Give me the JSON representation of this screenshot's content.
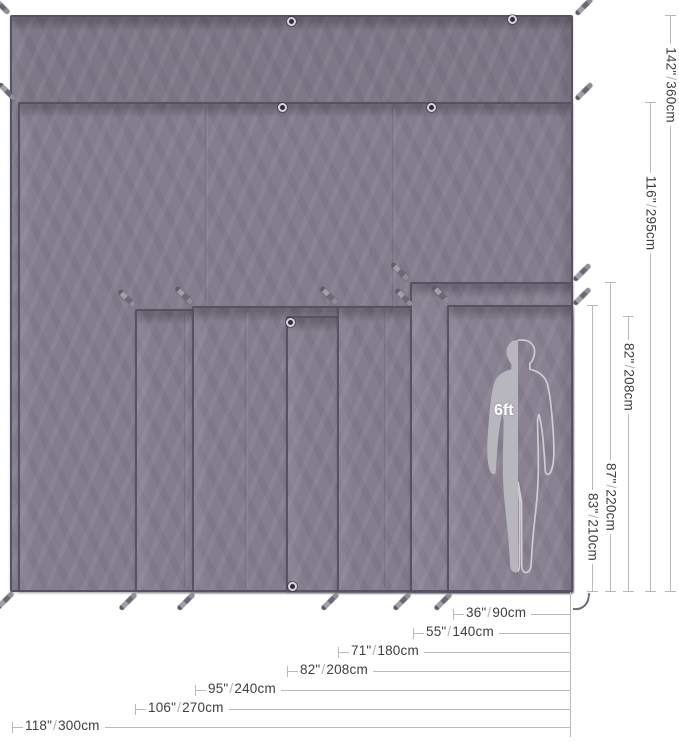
{
  "person": {
    "label": "6ft"
  },
  "colors": {
    "fabric_dark": "#7d7787",
    "fabric_mid": "#837d8e",
    "fabric_light": "#878192",
    "tarp_edge": "#575262",
    "dim_line": "#b9b9b9",
    "dim_text": "#3e3e3e",
    "dim_slash": "#b0b0b0",
    "silhouette_fill": "#b8b6bd",
    "silhouette_outline": "#cfcdd4",
    "background": "#ffffff"
  },
  "baseline": {
    "bottom_y": 592,
    "right_x": 573,
    "connector_x": 570,
    "connector_top": 592,
    "connector_bottom": 737
  },
  "tarps": [
    {
      "width_label": "118\"/300cm",
      "height_label": "142\"/360cm",
      "x": 10,
      "y": 15,
      "w": 563,
      "h": 577,
      "shade": "dark",
      "seams": []
    },
    {
      "width_label": "",
      "height_label": "116\"/295cm",
      "x": 18,
      "y": 102,
      "w": 555,
      "h": 490,
      "shade": "mid",
      "seams": [
        185,
        372
      ]
    },
    {
      "width_label": "106\"/270cm",
      "height_label": "",
      "x": 135,
      "y": 309,
      "w": 438,
      "h": 283,
      "shade": "mid",
      "seams": [
        47
      ]
    },
    {
      "width_label": "95\"/240cm",
      "height_label": "",
      "x": 192,
      "y": 306,
      "w": 381,
      "h": 286,
      "shade": "mid",
      "seams": [
        51
      ]
    },
    {
      "width_label": "82\"/208cm",
      "height_label": "82\"/208cm",
      "x": 286,
      "y": 316,
      "w": 287,
      "h": 276,
      "shade": "mid",
      "seams": []
    },
    {
      "width_label": "71\"/180cm",
      "height_label": "",
      "x": 337,
      "y": 306,
      "w": 236,
      "h": 286,
      "shade": "mid",
      "seams": [
        45
      ]
    },
    {
      "width_label": "55\"/140cm",
      "height_label": "87\"/220cm",
      "x": 410,
      "y": 282,
      "w": 163,
      "h": 310,
      "shade": "light",
      "seams": []
    },
    {
      "width_label": "36\"/90cm",
      "height_label": "83\"/210cm",
      "x": 447,
      "y": 305,
      "w": 126,
      "h": 287,
      "shade": "light",
      "seams": []
    }
  ],
  "height_dims": [
    {
      "inches": "142\"",
      "cm": "360cm",
      "x": 670,
      "top": 15,
      "label_center": 85
    },
    {
      "inches": "116\"",
      "cm": "295cm",
      "x": 650,
      "top": 102,
      "label_center": 213
    },
    {
      "inches": "82\"",
      "cm": "208cm",
      "x": 628,
      "top": 316,
      "label_center": 377
    },
    {
      "inches": "87\"",
      "cm": "220cm",
      "x": 610,
      "top": 282,
      "label_center": 497
    },
    {
      "inches": "83\"",
      "cm": "210cm",
      "x": 592,
      "top": 305,
      "label_center": 527
    }
  ],
  "width_dims": [
    {
      "inches": "36\"",
      "cm": "90cm",
      "y": 614,
      "x0": 453
    },
    {
      "inches": "55\"",
      "cm": "140cm",
      "y": 633,
      "x0": 413
    },
    {
      "inches": "71\"",
      "cm": "180cm",
      "y": 652,
      "x0": 338
    },
    {
      "inches": "82\"",
      "cm": "208cm",
      "y": 671,
      "x0": 287
    },
    {
      "inches": "95\"",
      "cm": "240cm",
      "y": 690,
      "x0": 195
    },
    {
      "inches": "106\"",
      "cm": "270cm",
      "y": 709,
      "x0": 135
    },
    {
      "inches": "118\"",
      "cm": "300cm",
      "y": 727,
      "x0": 12
    }
  ],
  "grommets": [
    {
      "x": 291,
      "y": 21
    },
    {
      "x": 512,
      "y": 19
    },
    {
      "x": 282,
      "y": 107
    },
    {
      "x": 431,
      "y": 107
    },
    {
      "x": 290,
      "y": 322
    },
    {
      "x": 292,
      "y": 586
    }
  ],
  "stakes": [
    {
      "x": 1,
      "y": 5,
      "dir": "ul"
    },
    {
      "x": 7,
      "y": 91,
      "dir": "ul"
    },
    {
      "x": 127,
      "y": 298,
      "dir": "ul"
    },
    {
      "x": 184,
      "y": 295,
      "dir": "ul"
    },
    {
      "x": 329,
      "y": 295,
      "dir": "ul"
    },
    {
      "x": 400,
      "y": 271,
      "dir": "ul"
    },
    {
      "x": 404,
      "y": 297,
      "dir": "ul"
    },
    {
      "x": 441,
      "y": 294,
      "dir": "ul"
    },
    {
      "x": 584,
      "y": 6,
      "dir": "ur"
    },
    {
      "x": 584,
      "y": 91,
      "dir": "ur"
    },
    {
      "x": 582,
      "y": 272,
      "dir": "ur"
    },
    {
      "x": 582,
      "y": 296,
      "dir": "ur"
    },
    {
      "x": 5,
      "y": 600,
      "dir": "dl"
    },
    {
      "x": 128,
      "y": 601,
      "dir": "dl"
    },
    {
      "x": 186,
      "y": 601,
      "dir": "dl"
    },
    {
      "x": 330,
      "y": 601,
      "dir": "dl"
    },
    {
      "x": 402,
      "y": 601,
      "dir": "dl"
    },
    {
      "x": 443,
      "y": 601,
      "dir": "dl"
    }
  ],
  "hook": {
    "x": 574,
    "y": 592
  },
  "person_box": {
    "x": 466,
    "y": 338,
    "w": 104,
    "h": 238,
    "label_x": 494,
    "label_y": 402
  }
}
